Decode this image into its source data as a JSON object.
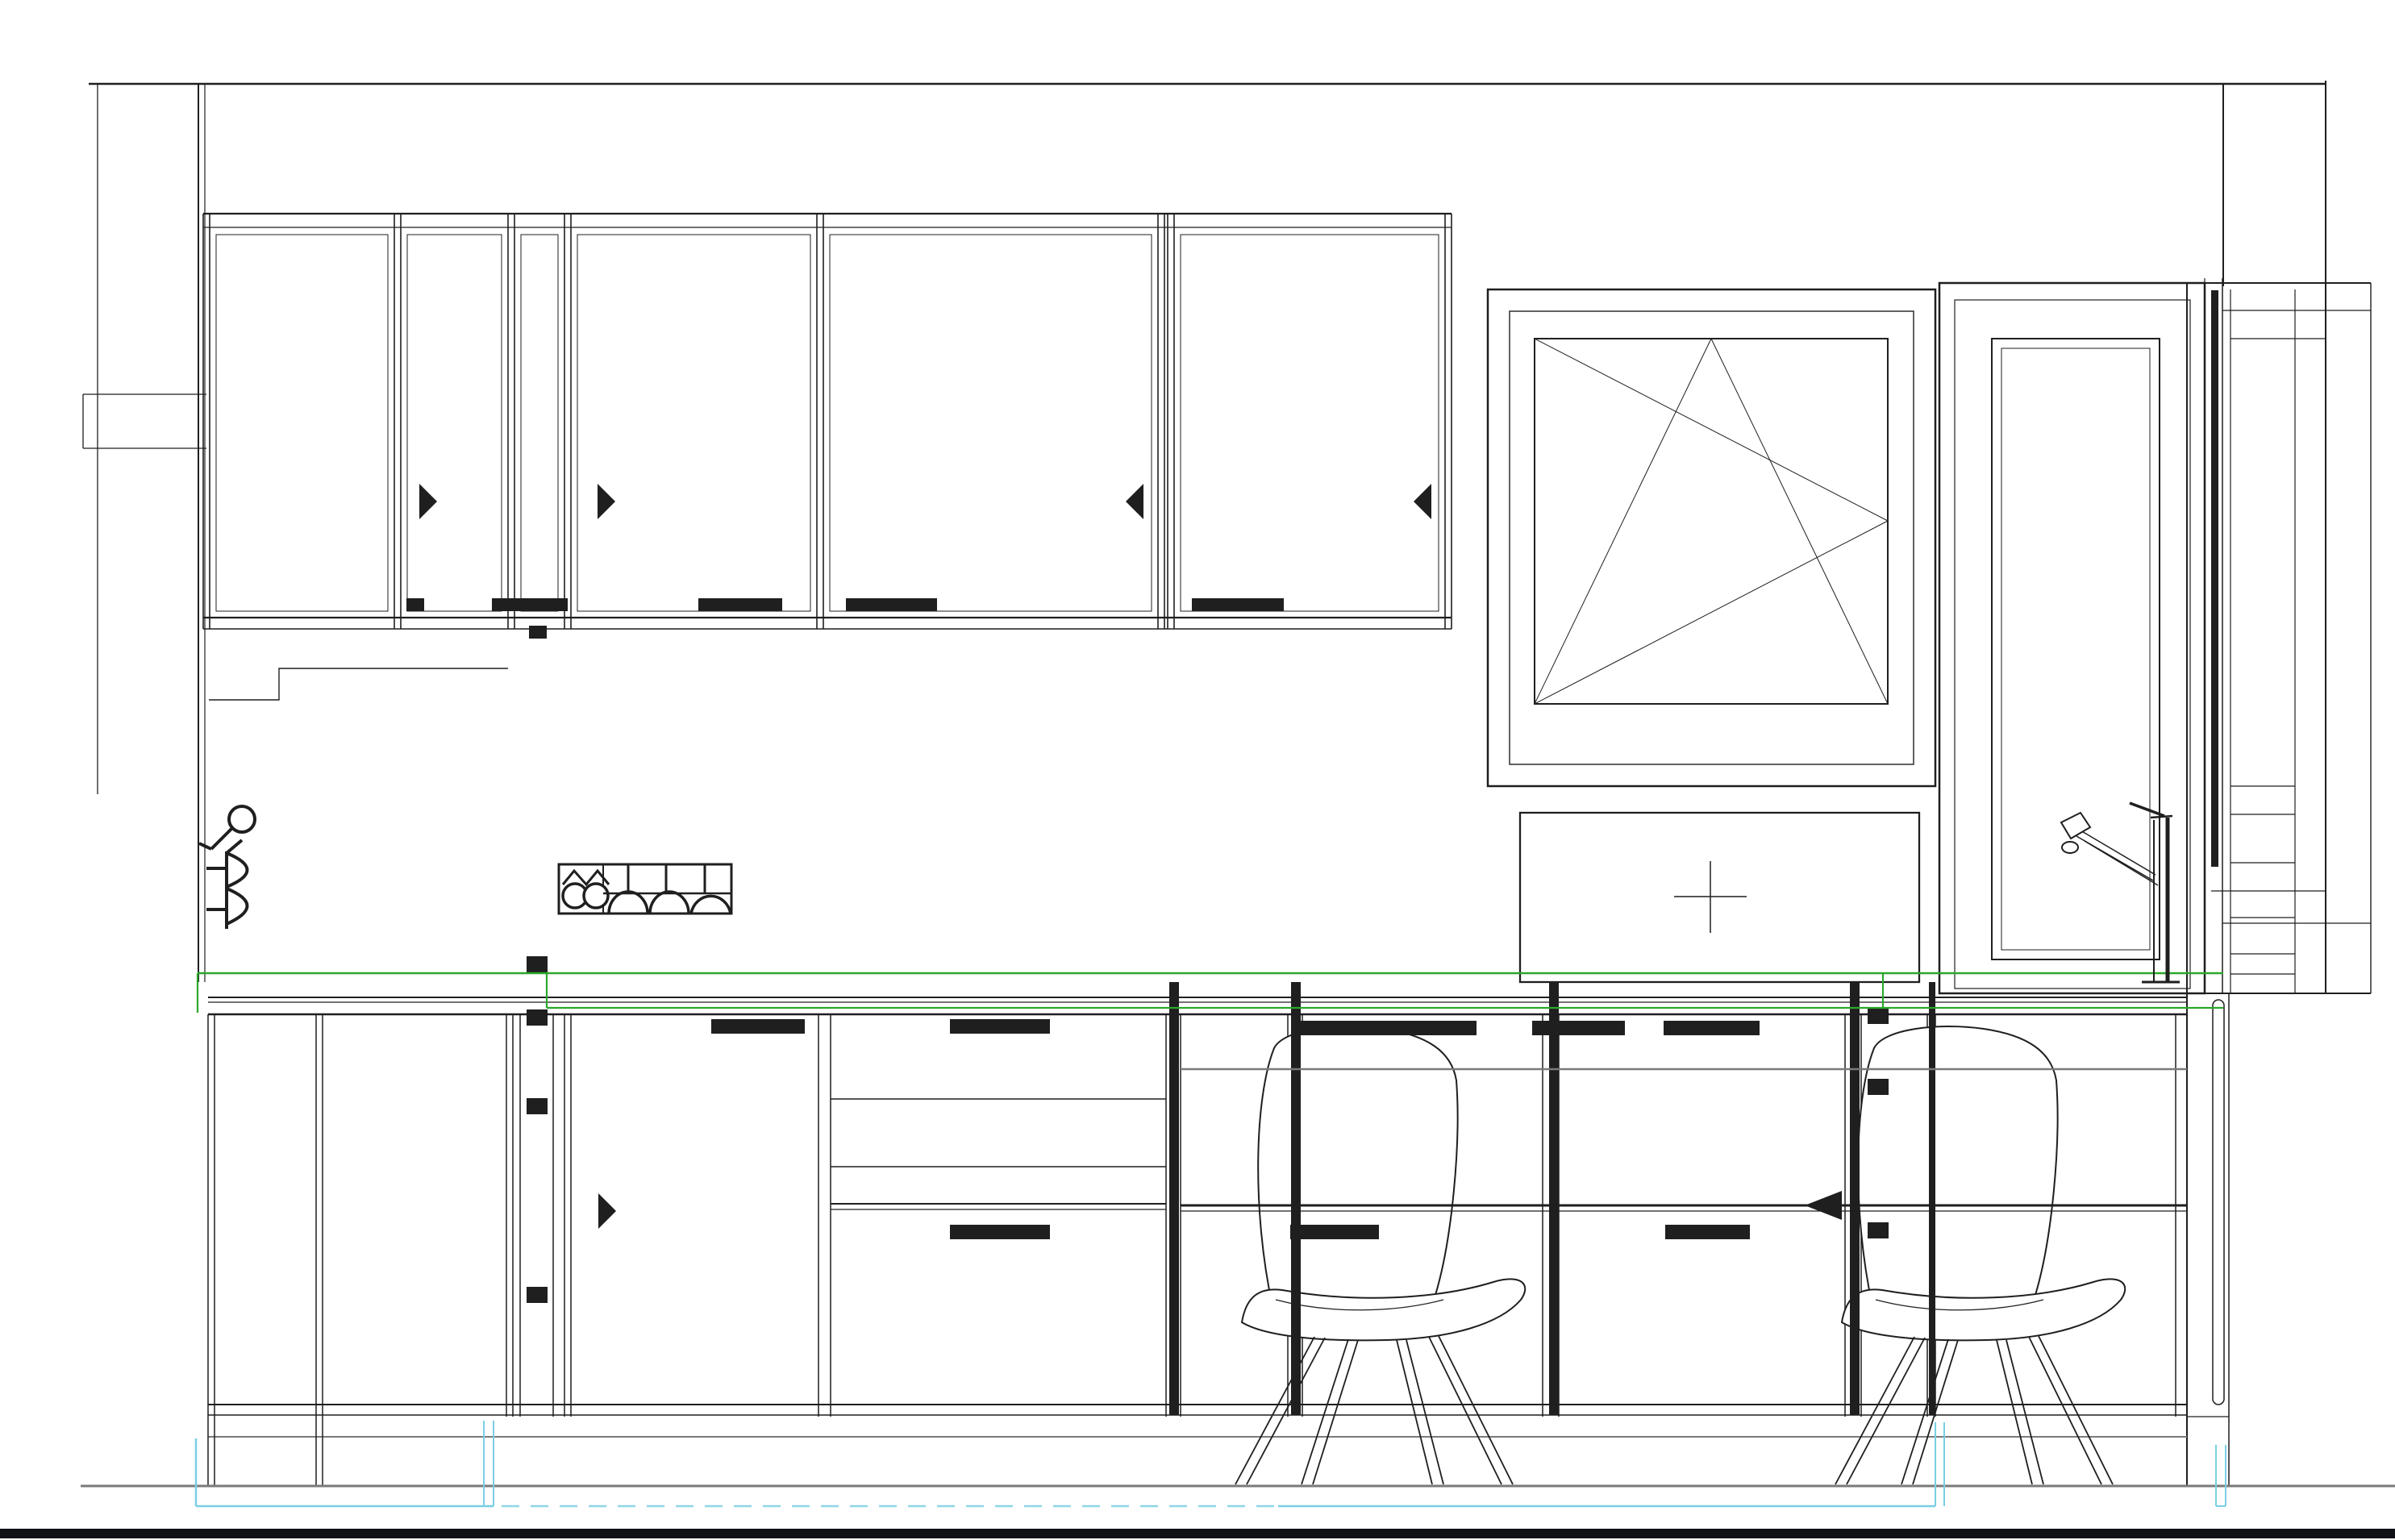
{
  "title": "Kitchen wall elevation - CAD wireframe drawing",
  "drawing": {
    "type": "architectural-interior-elevation",
    "units_visible": false,
    "text_visible": false,
    "colors": {
      "paper": "#ffffff",
      "line": "#1f1f1f",
      "gray": "#7a7a7a",
      "green": "#2aa82a",
      "cyan": "#79cfe3",
      "cyan_dash": "#8fd6e6",
      "floor_band": "#101018"
    },
    "elements": {
      "ceiling_line": {
        "present": true
      },
      "wall_cabinets": {
        "count": 5,
        "door_handles": 5,
        "hinge_arrow_markers": 4,
        "hinge_marker_direction": [
          "right",
          "right",
          "left",
          "left"
        ]
      },
      "tall_cabinet_left": {
        "present": true,
        "hinge_plate_markers": 4
      },
      "window": {
        "style": "tilt-and-turn",
        "opening_symbol": "double-triangle",
        "sill_panel_with_center_cross": true
      },
      "balcony_door": {
        "present": true,
        "position": "right",
        "glazed_panel": true
      },
      "faucet": {
        "present": true,
        "type": "single-lever-mixer",
        "location": "in-front-of-balcony-door"
      },
      "countertop_highlight": {
        "color": "#2aa82a",
        "lines": 2
      },
      "base_cabinets": {
        "door_count": 2,
        "drawer_fronts": 8,
        "section_cut_bars": 5,
        "hinge_plate_markers_right_strip": 3
      },
      "direction_arrow": {
        "present": true,
        "points": "left"
      },
      "bar_chairs": {
        "count": 2,
        "style": "shell-seat-splayed-wood-legs"
      },
      "electrical_symbols": {
        "switch_symbol": true,
        "socket_symbol": true,
        "outlet_strip_symbol": true
      },
      "plinth_highlight": {
        "color": "#79cfe3",
        "solid_segments": 2,
        "dashed_segment": 1
      },
      "floor_line": {
        "color": "#7a7a7a"
      },
      "bottom_band": {
        "color": "#101018"
      }
    }
  }
}
